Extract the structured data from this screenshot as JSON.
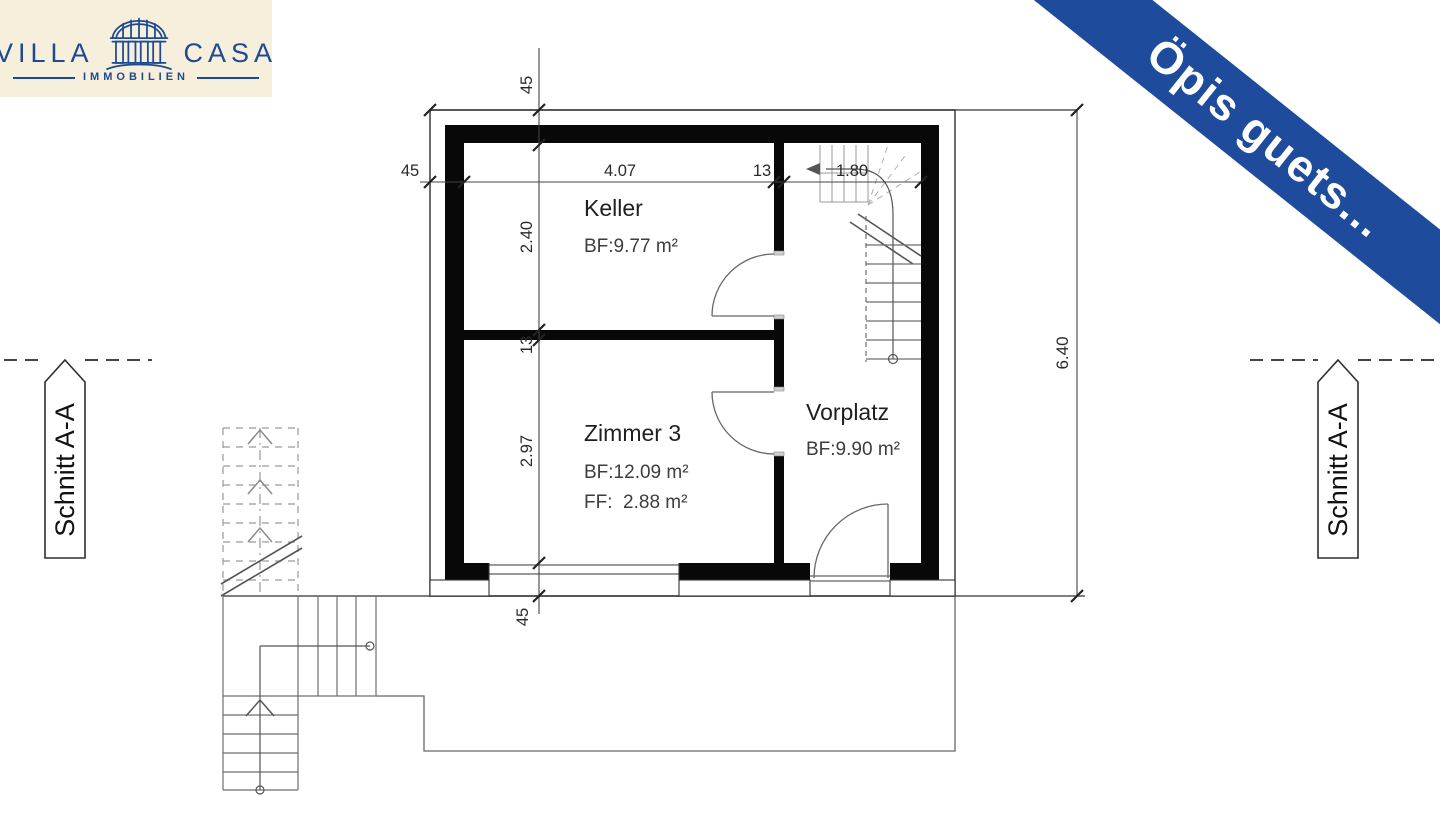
{
  "logo": {
    "brand_left": "VILLA",
    "brand_right": "CASA",
    "tagline": "IMMOBILIEN",
    "colors": {
      "background": "#f6efdb",
      "ink": "#1e4a94"
    }
  },
  "banner": {
    "text": "Öpis guets...",
    "colors": {
      "background": "#1e4b9c",
      "text": "#ffffff"
    }
  },
  "plan": {
    "rooms": {
      "keller": {
        "name": "Keller",
        "bf": "BF:9.77 m²"
      },
      "zimmer3": {
        "name": "Zimmer 3",
        "bf": "BF:12.09 m²",
        "ff": "FF:  2.88 m²"
      },
      "vorplatz": {
        "name": "Vorplatz",
        "bf": "BF:9.90 m²"
      }
    },
    "dimensions": {
      "horizontal": {
        "wall_left": "45",
        "keller_width": "4.07",
        "partition": "13",
        "vorplatz_width": "1.80"
      },
      "vertical": {
        "wall_top": "45",
        "keller_depth": "2.40",
        "partition": "13",
        "zimmer_depth": "2.97",
        "wall_bottom": "45"
      },
      "overall_height": "6.40"
    },
    "section_marker": "Schnitt A-A"
  }
}
